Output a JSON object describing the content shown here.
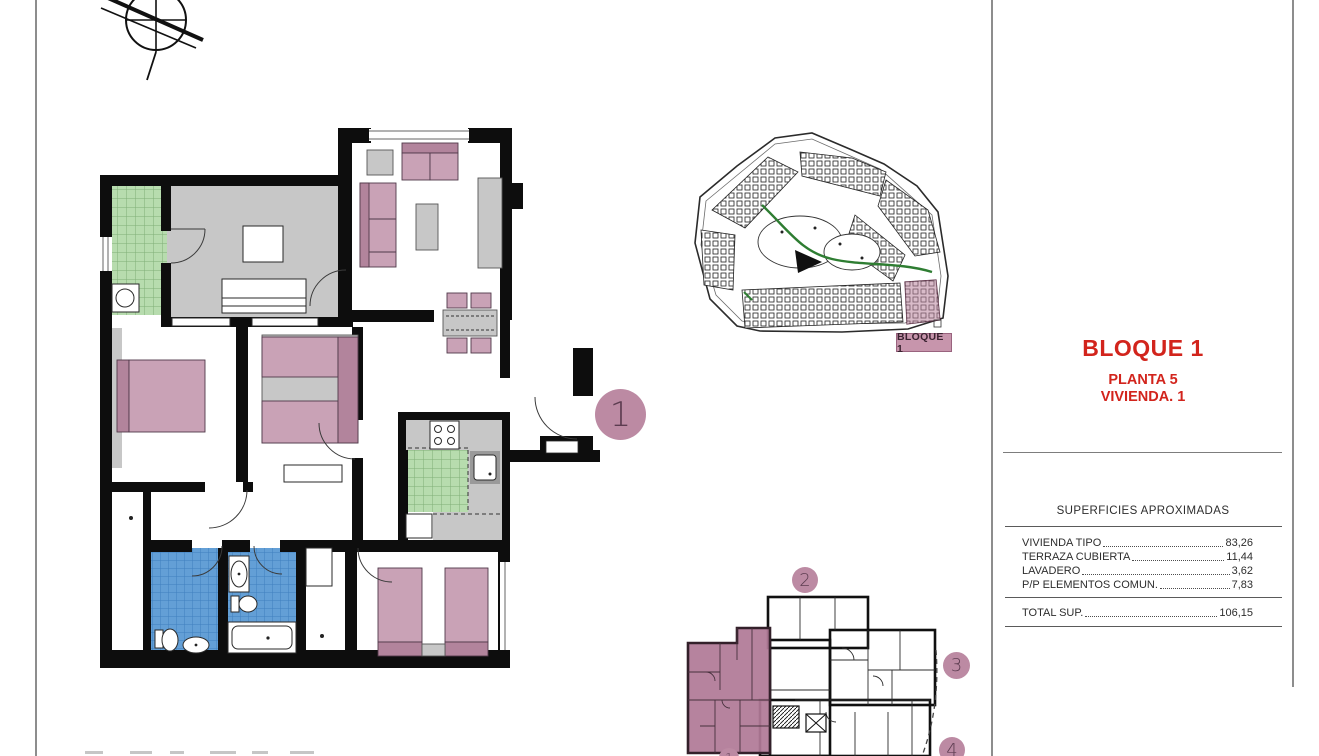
{
  "title_block": {
    "project": "BLOQUE 1",
    "floor": "PLANTA 5",
    "unit": "VIVIENDA. 1"
  },
  "site_plan": {
    "highlight_label": "BLOQUE 1"
  },
  "markers": {
    "selected_unit": "1",
    "unit_2": "2",
    "unit_3": "3",
    "unit_4": "4",
    "keyplan_selected": "1"
  },
  "areas_table": {
    "header": "SUPERFICIES APROXIMADAS",
    "rows": [
      {
        "label": "VIVIENDA TIPO",
        "value": "83,26"
      },
      {
        "label": "TERRAZA CUBIERTA",
        "value": "11,44"
      },
      {
        "label": "LAVADERO",
        "value": "3,62"
      },
      {
        "label": "P/P ELEMENTOS COMUN.",
        "value": "7,83"
      }
    ],
    "total_row": {
      "label": "TOTAL SUP.",
      "value": "106,15"
    }
  },
  "icons": {
    "north_arrow": "north-arrow-icon"
  },
  "colors": {
    "accent_red": "#d2241c",
    "unit_highlight": "#b07a97",
    "furniture_pink": "#c9a2b6",
    "furniture_pink_dark": "#b2849c",
    "tile_green": "#b7dcae",
    "tile_blue": "#639fd6",
    "floor_gray": "#c7c7c7",
    "marker_mauve": "#bc8aa3",
    "site_label_bg": "#c795ac"
  }
}
